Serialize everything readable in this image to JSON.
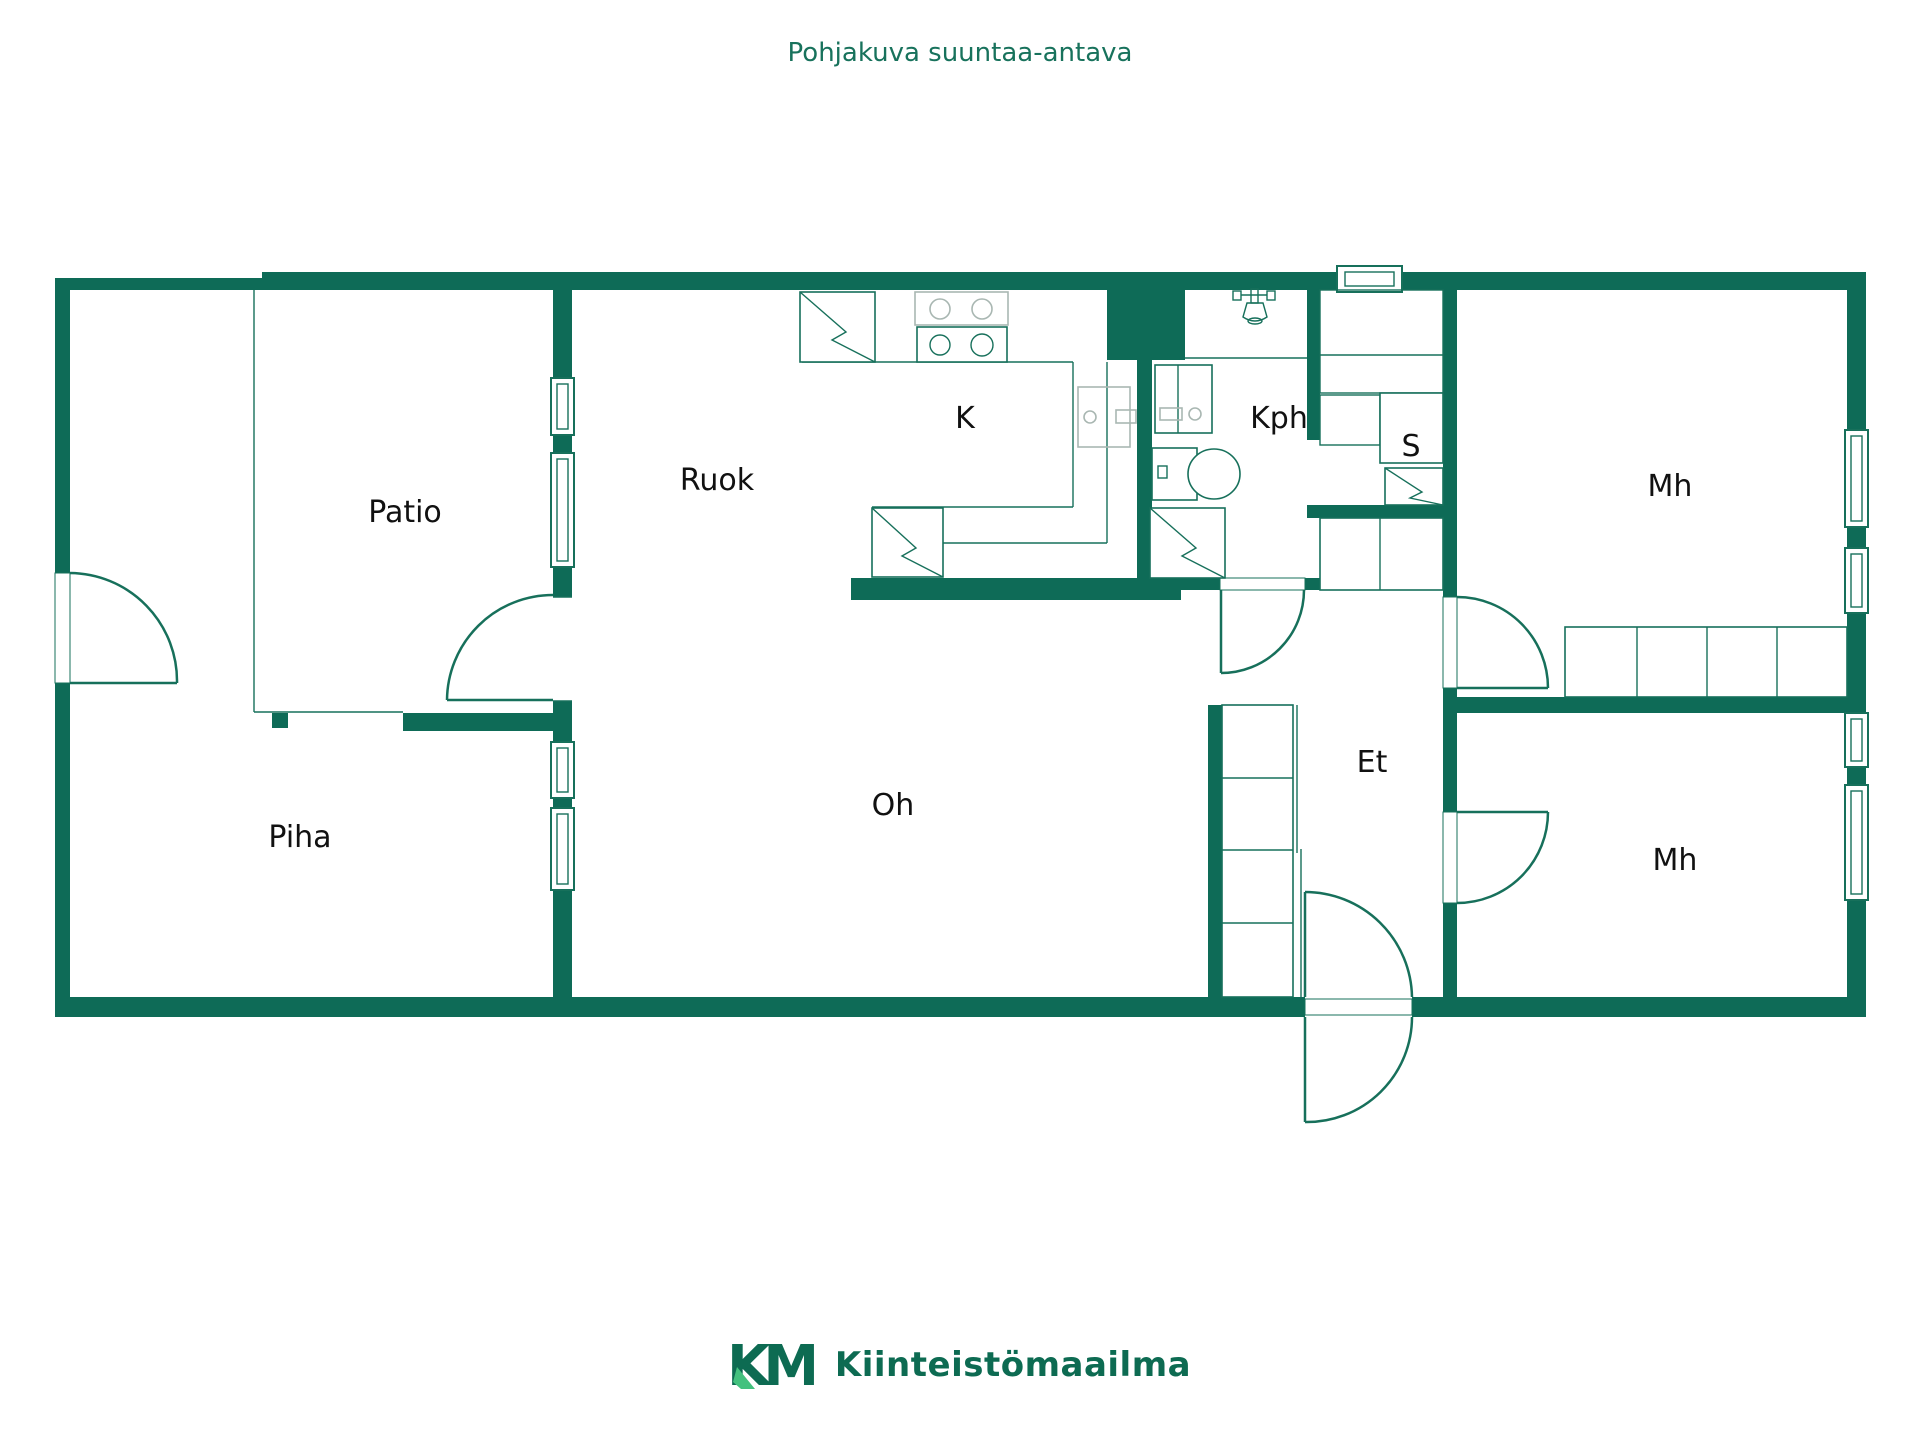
{
  "title": "Pohjakuva suuntaa-antava",
  "rooms": [
    {
      "id": "patio",
      "label": "Patio"
    },
    {
      "id": "piha",
      "label": "Piha"
    },
    {
      "id": "ruok",
      "label": "Ruok"
    },
    {
      "id": "k",
      "label": "K"
    },
    {
      "id": "oh",
      "label": "Oh"
    },
    {
      "id": "kph",
      "label": "Kph"
    },
    {
      "id": "s",
      "label": "S"
    },
    {
      "id": "et",
      "label": "Et"
    },
    {
      "id": "mh1",
      "label": "Mh"
    },
    {
      "id": "mh2",
      "label": "Mh"
    }
  ],
  "fixtures": [
    "refrigerator",
    "stove-4-burner",
    "kitchen-sink",
    "dishwasher",
    "washbasin-cabinet",
    "toilet",
    "shower",
    "water-heater",
    "sauna-benches",
    "sauna-stove",
    "wardrobe-row",
    "hall-closet"
  ],
  "logo": {
    "mark": "KM",
    "name": "Kiinteistömaailma"
  },
  "colors": {
    "wall": "#0e6b57",
    "line": "#17705b",
    "title_text": "#18725c",
    "label_text": "#111111",
    "logo_dark": "#0d6b52",
    "logo_light": "#43c17e",
    "stripe_gray": "#9aa7a2",
    "fixture_gray": "#a9b7b2"
  }
}
